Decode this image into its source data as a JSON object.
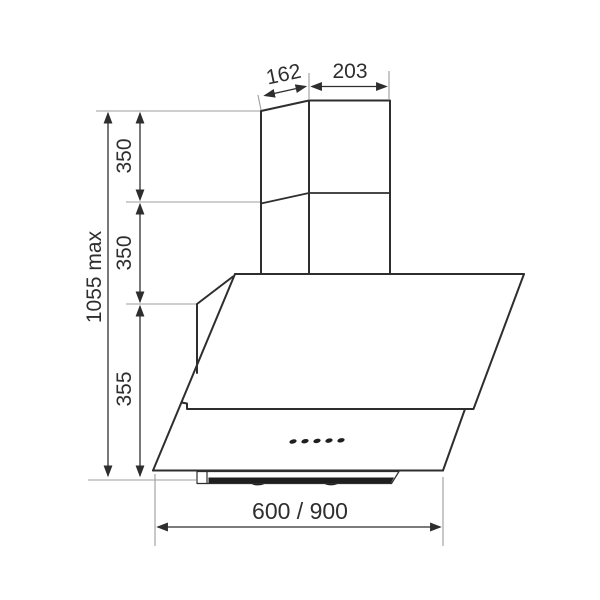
{
  "drawing": {
    "background_color": "#ffffff",
    "outline_color": "#2e2e2e",
    "dimension_color": "#2e2e2e",
    "extension_color": "#9c9c9c",
    "controls": {
      "button_count": 5
    },
    "dimensions": {
      "chimney_top_depth": "162",
      "chimney_top_width": "203",
      "chimney_upper_section_height": "350",
      "chimney_lower_section_height": "350",
      "hood_body_height": "355",
      "total_height": "1055 max",
      "hood_width": "600 / 900"
    }
  }
}
